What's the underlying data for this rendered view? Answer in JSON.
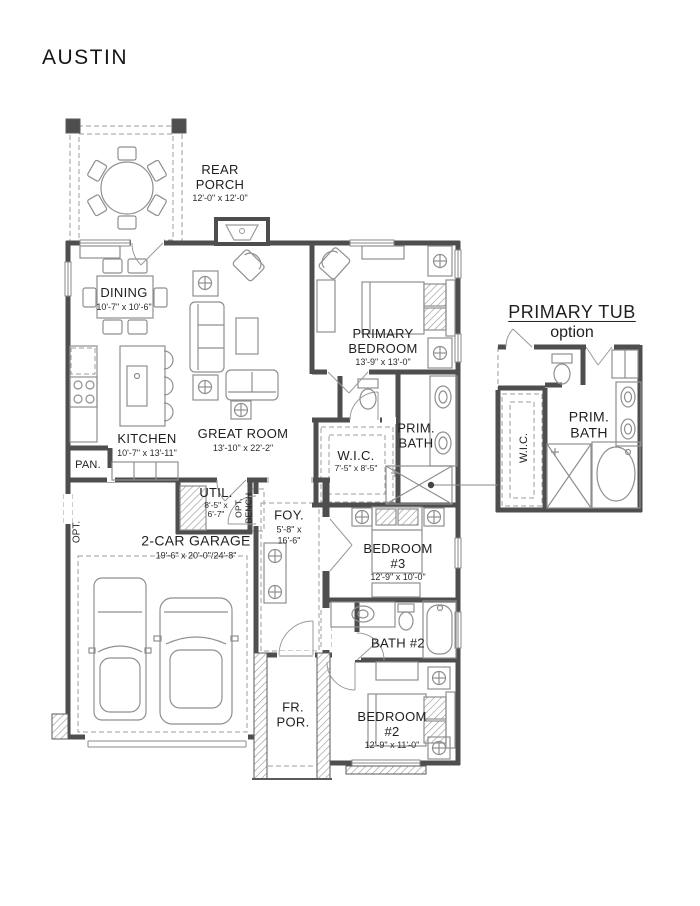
{
  "title": "AUSTIN",
  "rooms": {
    "rear_porch": {
      "line1": "REAR",
      "line2": "PORCH",
      "dims": "12'-0\" x 12'-0\""
    },
    "dining": {
      "name": "DINING",
      "dims": "10'-7\" x 10'-6\""
    },
    "primary_bedroom": {
      "line1": "PRIMARY",
      "line2": "BEDROOM",
      "dims": "13'-9\" x 13'-0\""
    },
    "kitchen": {
      "name": "KITCHEN",
      "dims": "10'-7\" x 13'-11\""
    },
    "great_room": {
      "name": "GREAT ROOM",
      "dims": "13'-10\" x 22'-2\""
    },
    "pantry": {
      "name": "PAN."
    },
    "wic": {
      "name": "W.I.C.",
      "dims": "7'-5\" x 8'-5\""
    },
    "prim_bath": {
      "line1": "PRIM.",
      "line2": "BATH"
    },
    "util": {
      "name": "UTIL.",
      "dims_line1": "8'-5\" x",
      "dims_line2": "6'-7\""
    },
    "opt_bench": {
      "line1": "OPT.",
      "line2": "BENCH"
    },
    "opt": {
      "name": "OPT."
    },
    "foyer": {
      "name": "FOY.",
      "dims_line1": "5'-8\" x",
      "dims_line2": "16'-6\""
    },
    "garage": {
      "name": "2-CAR GARAGE",
      "dims": "19'-6\" x 20'-0\"/24'-8\""
    },
    "bedroom3": {
      "line1": "BEDROOM",
      "line2": "#3",
      "dims": "12'-9\" x 10'-0\""
    },
    "bath2": {
      "name": "BATH #2"
    },
    "front_porch": {
      "line1": "FR.",
      "line2": "POR."
    },
    "bedroom2": {
      "line1": "BEDROOM",
      "line2": "#2",
      "dims": "12'-9\" x 11'-0\""
    }
  },
  "option_detail": {
    "title": "PRIMARY TUB",
    "subtitle": "option",
    "wic_label": "W.I.C.",
    "bath_line1": "PRIM.",
    "bath_line2": "BATH"
  },
  "colors": {
    "wall": "#4e4e4e",
    "furniture_line": "#8f8f8f",
    "text": "#1f1f1f",
    "background": "#ffffff"
  }
}
